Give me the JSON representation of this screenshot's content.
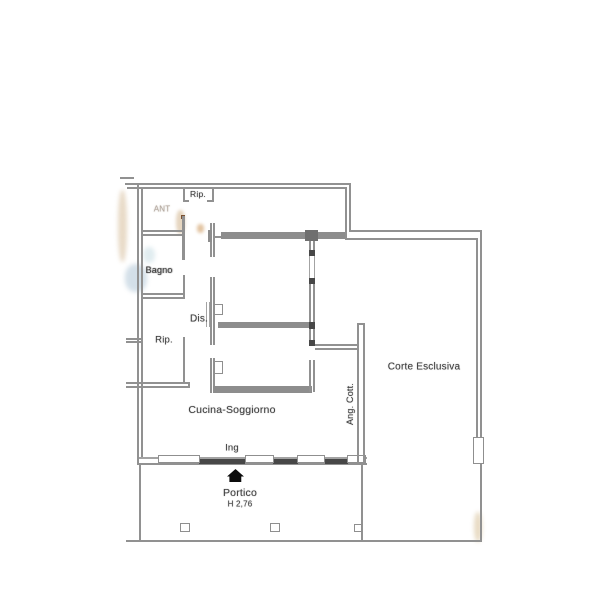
{
  "labels": {
    "storage_top": "Rip.",
    "anteroom": "ANT",
    "bathroom": "Bagno",
    "hallway": "Dis.",
    "storage_left": "Rip.",
    "kitchen_living": "Cucina-Soggiorno",
    "cooking_corner": "Ang. Cott.",
    "courtyard": "Corte Esclusiva",
    "entrance": "Ing",
    "porch": "Portico",
    "porch_height": "H 2,76"
  },
  "icons": {
    "entrance_marker": "filled-house-arrow"
  },
  "colors": {
    "background": "#ffffff",
    "wall": "#919191",
    "wall_thick": "#8d8d8d",
    "wall_dark": "#474747",
    "text": "#3f3f3f",
    "marker": "#0d0d0d",
    "artifact_tan": "#d9c2a2",
    "artifact_blue": "#a8c0d2"
  }
}
